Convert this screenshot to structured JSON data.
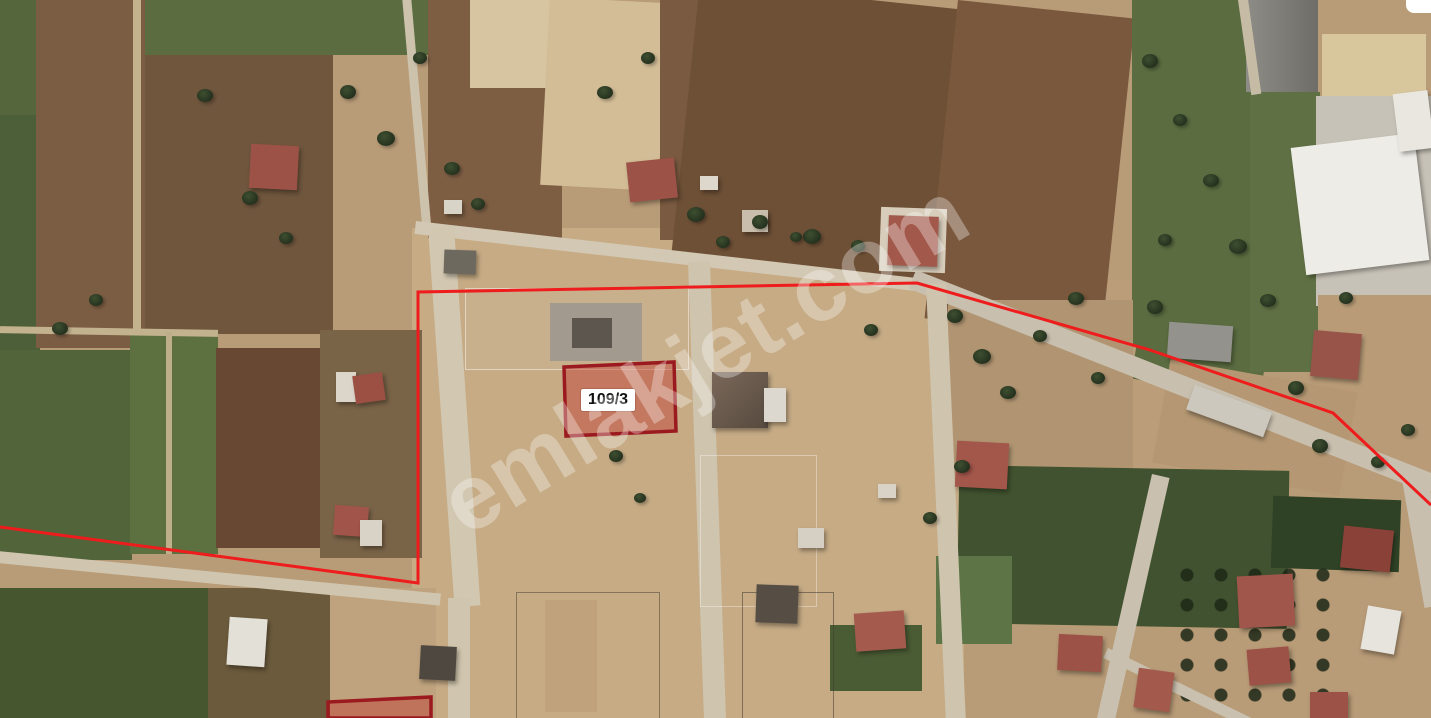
{
  "map": {
    "watermark_text": "emlakjet.com",
    "boundary": {
      "color": "#ee1c1c",
      "points": "0,527 418,583 418,292 917,283 1150,350 1333,413 1431,505"
    },
    "parcels": [
      {
        "label": "109/3",
        "points": "564,367 674,362 676,431 566,436"
      },
      {
        "label": "",
        "points": "328,702 431,697 431,718 328,718"
      }
    ],
    "colors": {
      "boundary_red": "#ee1c1c",
      "parcel_fill": "rgba(193,58,48,0.45)",
      "parcel_stroke": "#9b1a1f",
      "parcel_label_bg": "#ffffff",
      "parcel_label_text": "#111111",
      "watermark": "#ffffff"
    }
  }
}
